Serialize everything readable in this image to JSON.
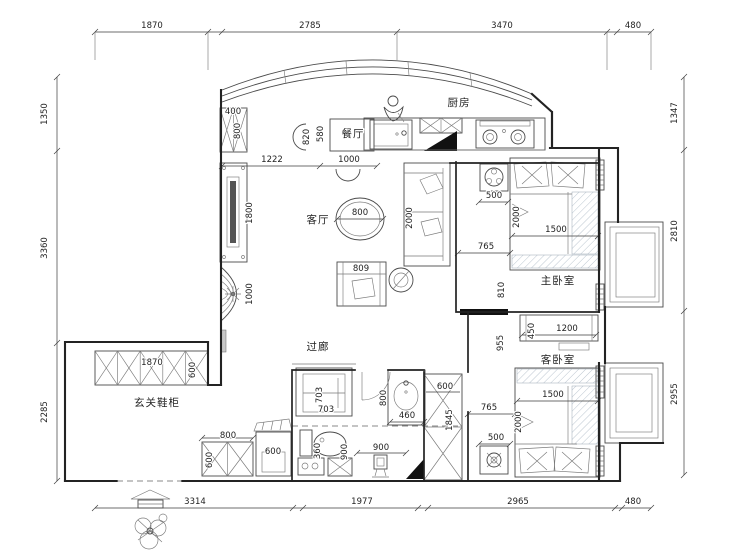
{
  "title": "apartment-floor-plan",
  "rooms": {
    "kitchen": "厨房",
    "dining": "餐厅",
    "living": "客厅",
    "master": "主卧室",
    "guest": "客卧室",
    "corridor": "过廊",
    "entry": "玄关鞋柜"
  },
  "dims": {
    "top": [
      "1870",
      "2785",
      "3470",
      "480"
    ],
    "bottom": [
      "3314",
      "1977",
      "2965",
      "480"
    ],
    "left": [
      "1350",
      "3360",
      "2285"
    ],
    "right": [
      "1347",
      "2810",
      "2955"
    ]
  },
  "in": {
    "cab400": "400",
    "cab800": "800",
    "off1222": "1222",
    "chair820": "820",
    "table580": "580",
    "table1000": "1000",
    "tv1800": "1800",
    "shelf1000": "1000",
    "tea800": "800",
    "sofa2000": "2000",
    "chair809": "809",
    "mns500": "500",
    "mbed2000": "2000",
    "mbed1500": "1500",
    "mgap765": "765",
    "mdoor810": "810",
    "gcab450": "450",
    "gcab1200": "1200",
    "corr955": "955",
    "gbed1500": "1500",
    "gbed2000": "2000",
    "ggap765": "765",
    "gns500": "500",
    "ward600": "600",
    "ward1845": "1845",
    "wash703a": "703",
    "wash703b": "703",
    "wc360": "360",
    "bath900": "900",
    "sink800": "800",
    "sink460": "460",
    "corr900": "900",
    "shoe1870": "1870",
    "shoe600": "600",
    "bench800": "800",
    "bench600": "600",
    "lid600": "600"
  }
}
